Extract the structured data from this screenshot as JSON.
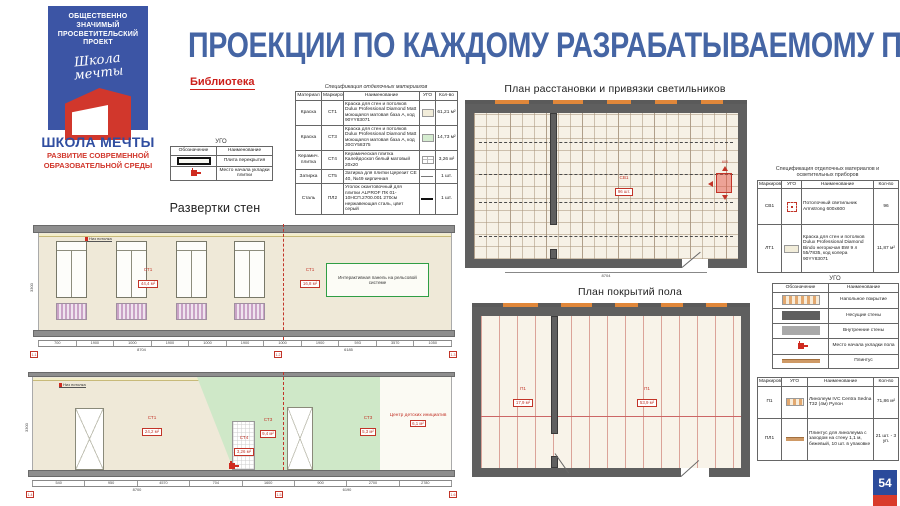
{
  "slide": {
    "title": "ПРОЕКЦИИ ПО КАЖДОМУ РАЗРАБАТЫВАЕМОМУ ПОМЕЩЕНИЮ",
    "page_number": "54"
  },
  "colors": {
    "accent_blue": "#3c55a5",
    "accent_red": "#d1372c",
    "title_blue": "#4565a4",
    "wall_beige": "#efe9d8",
    "zone_green": "#cfe8c8",
    "slab_gray": "#8e8e8e",
    "structure_gray": "#5f5f5f",
    "strip_orange": "#e0873a",
    "radiator_purple": "#c9a2c6",
    "panel_green_border": "#2f9e44"
  },
  "logo": {
    "project": "ОБЩЕСТВЕННО ЗНАЧИМЫЙ ПРОСВЕТИТЕЛЬСКИЙ ПРОЕКТ",
    "script": "Школа мечты",
    "name": "ШКОЛА МЕЧТЫ",
    "tagline": "РАЗВИТИЕ СОВРЕМЕННОЙ ОБРАЗОВАТЕЛЬНОЙ СРЕДЫ"
  },
  "library": {
    "label": "Библиотека"
  },
  "materials": {
    "title": "Спецификация отделочных материалов",
    "headers": [
      "Материал",
      "Маркировка",
      "Наименование",
      "УГО",
      "Кол-во"
    ],
    "rows": [
      {
        "material": "Краска",
        "mark": "СТ1",
        "name": "Краска для стен и потолков Dulux Professional Diamond Matt моющаяся матовая база A, код 90YY83071",
        "qty": "61,21 м²"
      },
      {
        "material": "Краска",
        "mark": "СТ3",
        "name": "Краска для стен и потолков Dulux Professional Diamond Matt моющаяся матовая база A, код 30GY58375",
        "qty": "14,73 м²"
      },
      {
        "material": "Керамич. плитка",
        "mark": "СТ4",
        "name": "Керамическая плитка Калейдоскоп белый матовый 20x20",
        "qty": "3,26 м²"
      },
      {
        "material": "Затирка",
        "mark": "СТ5",
        "name": "Затирка для плитки Церезит CE 40, №49 кирпичная",
        "qty": "1 шт."
      },
      {
        "material": "Сталь",
        "mark": "ПЛ2",
        "name": "Уголок окантовочный для плитки ALPROF ПК 01-10НСП.2700.001 270см нержавеющая сталь, цвет серый",
        "qty": "1 шт."
      }
    ]
  },
  "ugo_wall": {
    "title": "УГО",
    "headers": [
      "Обозначение",
      "Наименование"
    ],
    "rows": [
      {
        "name": "Плита перекрытия"
      },
      {
        "name": "Место начала укладки плитки"
      }
    ]
  },
  "elevations": {
    "heading": "Развертки стен",
    "top": {
      "ceiling_note": "Низ потолка",
      "st1_mark": "СТ1",
      "st1_area": "44,4 м²",
      "st1b_mark": "СТ1",
      "st1b_area": "16,8 м²",
      "panel_note": "Интерактивная панель на рельсовой системе",
      "vdim": "3300",
      "dims": [
        "700",
        "1900",
        "1000",
        "1900",
        "1000",
        "1900",
        "1000",
        "1900",
        "593",
        "3570",
        "1050"
      ],
      "total_left": "8704",
      "total_right": "6185",
      "markers": [
        "1.1",
        "1.2",
        "1.3"
      ]
    },
    "bottom": {
      "ceiling_note": "Низ потолка",
      "st1_mark": "СТ1",
      "st1_area": "24,2 м²",
      "st3_mark": "СТ3",
      "st3_area": "9,4 м²",
      "st4_mark": "СТ4",
      "st4_area": "3,26 м²",
      "st3b_mark": "СТ3",
      "st3b_area": "5,3 м²",
      "center_note": "Центр детских инициатив",
      "center_area": "6,1 м²",
      "vdim": "3300",
      "dims": [
        "540",
        "950",
        "4570",
        "704",
        "1600",
        "900",
        "2700",
        "2780"
      ],
      "total_left": "8700",
      "total_right": "6190",
      "markers": [
        "1.4",
        "1.5",
        "1.6"
      ]
    }
  },
  "ceiling_plan": {
    "title": "План расстановки и привязки светильников",
    "label_mark": "СВ1",
    "label_qty": "96 шт.",
    "fixture_dim": "600",
    "bottom_dim": "8704"
  },
  "floor_plan": {
    "title": "План покрытий пола",
    "left_mark": "П1",
    "left_area": "17,9 м²",
    "right_mark": "П1",
    "right_area": "53,9 м²"
  },
  "lights_table": {
    "title": "Спецификация отделочных материалов и осветительных приборов",
    "headers": [
      "Маркировка",
      "УГО",
      "Наименование",
      "Кол-во"
    ],
    "rows": [
      {
        "mark": "СВ1",
        "name": "Потолочный светильник Armstrong 600x600",
        "qty": "96"
      },
      {
        "mark": "ЛТ1",
        "name": "Краска для стен и потолков Dulux Professional Diamond Bindo негорючая BW 9 л 55/7835, код колера 90YY83071",
        "qty": "11,87 м²"
      }
    ]
  },
  "ugo_floor": {
    "title": "УГО",
    "headers": [
      "Обозначение",
      "Наименование"
    ],
    "rows": [
      {
        "name": "Напольное покрытие"
      },
      {
        "name": "Несущие стены"
      },
      {
        "name": "Внутренние стены"
      },
      {
        "name": "Место начала укладки пола"
      },
      {
        "name": "Плинтус"
      }
    ]
  },
  "floor_table": {
    "headers": [
      "Маркировка",
      "УГО",
      "Наименование",
      "Кол-во"
    ],
    "rows": [
      {
        "mark": "П1",
        "name": "Линолеум IVC Centra Sedna T32 (4м) Рулон",
        "qty": "71,86 м²"
      },
      {
        "mark": "ПЛ1",
        "name": "Плинтус для линолеума с заходом на стену 1,1 м, бежевый, 10 шт. в упаковке",
        "qty": "21 шт. - 3 уп."
      }
    ]
  }
}
